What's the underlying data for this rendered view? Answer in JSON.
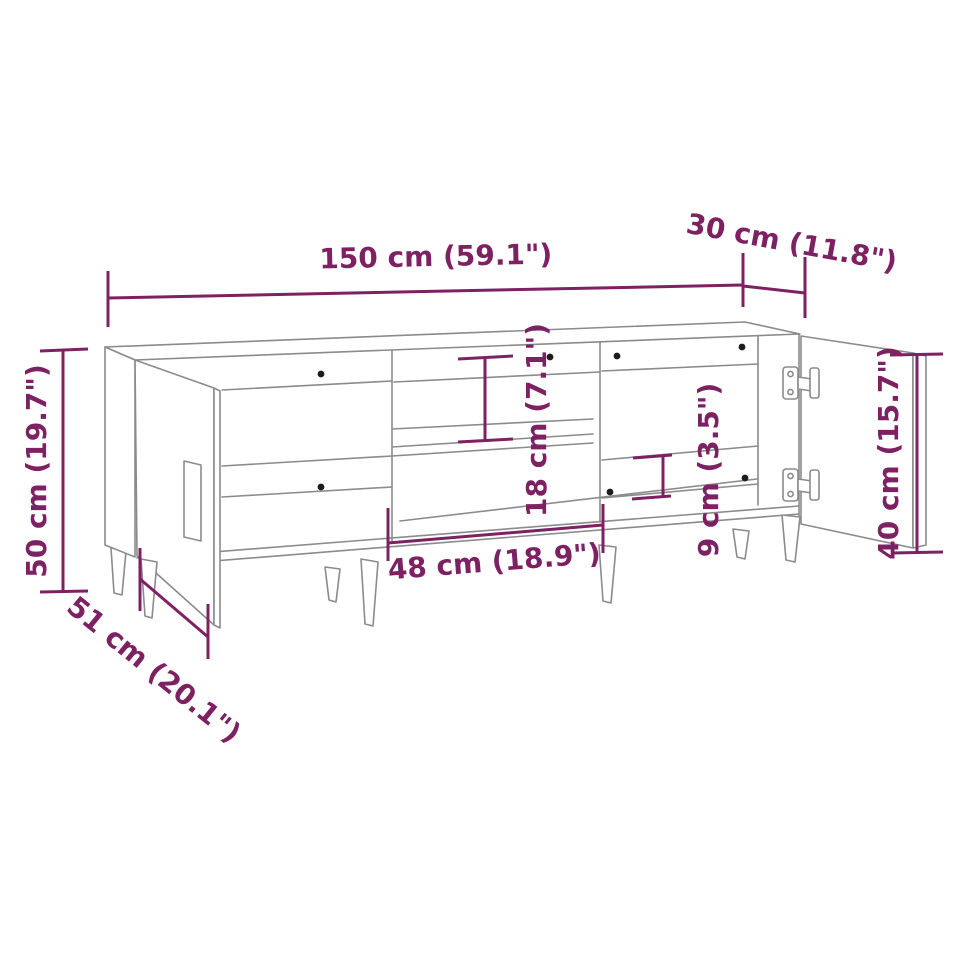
{
  "page": {
    "title": "TV stand dimensions diagram",
    "background": "#ffffff"
  },
  "diagram": {
    "subject": "TV stand line drawing with two open doors, middle shelf compartment, concealed hinges and tapered legs",
    "style": {
      "dimension_color": "#7d2163",
      "outline_color": "#8b8b8b",
      "hardware_color": "#1c1c1c",
      "background": "#ffffff"
    }
  },
  "dimensions": {
    "overall_width": {
      "label": "150 cm (59.1\")",
      "cm": 150,
      "inches": 59.1
    },
    "depth": {
      "label": "30 cm (11.8\")",
      "cm": 30,
      "inches": 11.8
    },
    "overall_height": {
      "label": "50 cm (19.7\")",
      "cm": 50,
      "inches": 19.7
    },
    "depth_door_open": {
      "label": "51 cm (20.1\")",
      "cm": 51,
      "inches": 20.1
    },
    "middle_compartment_width": {
      "label": "48 cm (18.9\")",
      "cm": 48,
      "inches": 18.9
    },
    "shelf_compartment_height": {
      "label": "18 cm (7.1\")",
      "cm": 18,
      "inches": 7.1
    },
    "bottom_rail_height": {
      "label": "9 cm (3.5\")",
      "cm": 9,
      "inches": 3.5
    },
    "door_height": {
      "label": "40 cm (15.7\")",
      "cm": 40,
      "inches": 15.7
    }
  }
}
